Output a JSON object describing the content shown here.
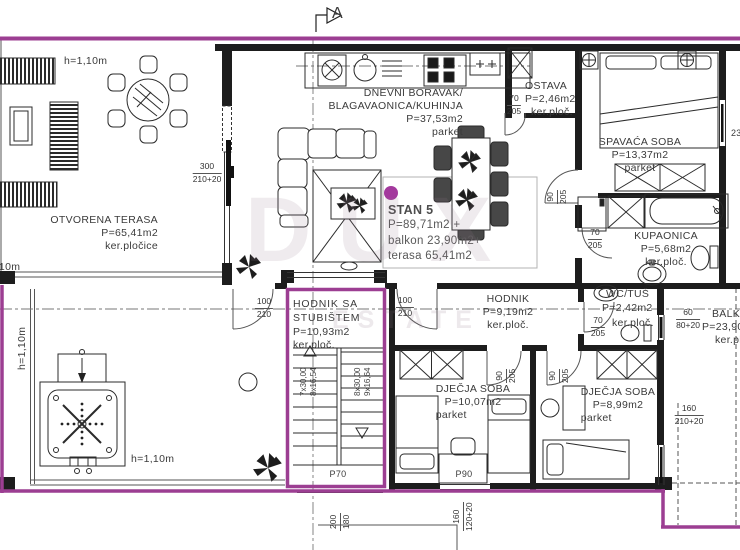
{
  "plan": {
    "accent_color": "#9c3e92",
    "section_marker": "A",
    "watermark": {
      "line1": "DUX",
      "line2": "ESTATE"
    },
    "terrace_top": {
      "name": "OTVORENA TERASA",
      "area": "P=65,41m2",
      "floor": "ker.pločice",
      "railing_height": "h=1,10m"
    },
    "terrace_bottom": {
      "railing_left": "h=1,10m",
      "railing_bottom": "h=1,10m",
      "railing_top": "h=1,10m"
    },
    "living": {
      "name_line1": "DNEVNI BORAVAK/",
      "name_line2": "BLAGAVAONICA/KUHINJA",
      "area": "P=37,53m2",
      "floor": "parket",
      "door_w": "300",
      "door_h": "210+20"
    },
    "stan5": {
      "title": "STAN 5",
      "line1": "P=89,71m2 +",
      "line2": "balkon 23,90m2+",
      "line3": "terasa 65,41m2"
    },
    "ostava": {
      "name": "OSTAVA",
      "area": "P=2,46m2",
      "floor": "ker.ploč.",
      "door_w": "70",
      "door_h": "205"
    },
    "bedroom": {
      "name": "SPAVAĆA SOBA",
      "area": "P=13,37m2",
      "floor": "parket",
      "door_w": "90",
      "door_h": "205",
      "window": "230"
    },
    "bathroom": {
      "name": "KUPAONICA",
      "area": "P=5,68m2",
      "floor": "ker.ploč.",
      "door_w": "70",
      "door_h": "205"
    },
    "hallway": {
      "name": "HODNIK",
      "area": "P=9,19m2",
      "floor": "ker.ploč.",
      "door_w": "100",
      "door_h": "210"
    },
    "wc": {
      "name": "WC/TUŠ",
      "area": "P=2,42m2",
      "floor": "ker.ploč.",
      "door_w": "70",
      "door_h": "205"
    },
    "stairhall": {
      "name_line1": "HODNIK SA",
      "name_line2": "STUBIŠTEM",
      "area": "P=10,93m2",
      "floor": "ker.ploč.",
      "door_w": "100",
      "door_h": "210",
      "stairs_left_a": "7x30,00",
      "stairs_left_b": "8x16,54",
      "stairs_right_a": "8x30,00",
      "stairs_right_b": "9x16,64",
      "window": "P70",
      "dim_w": "200",
      "dim_h": "180"
    },
    "kids1": {
      "name": "DJEČJA SOBA",
      "area": "P=10,07m2",
      "floor": "parket",
      "door_w": "90",
      "door_h": "205",
      "window": "P90",
      "win_w": "160",
      "win_h": "120+20"
    },
    "kids2": {
      "name": "DJEČJA SOBA",
      "area": "P=8,99m2",
      "floor": "parket",
      "door_w": "90",
      "door_h": "205",
      "win_w": "160",
      "win_h": "210+20"
    },
    "balcony": {
      "name": "BALKON",
      "area": "P=23,90m2",
      "floor": "ker.ploč.",
      "win_w": "60",
      "win_h": "80+20"
    }
  }
}
